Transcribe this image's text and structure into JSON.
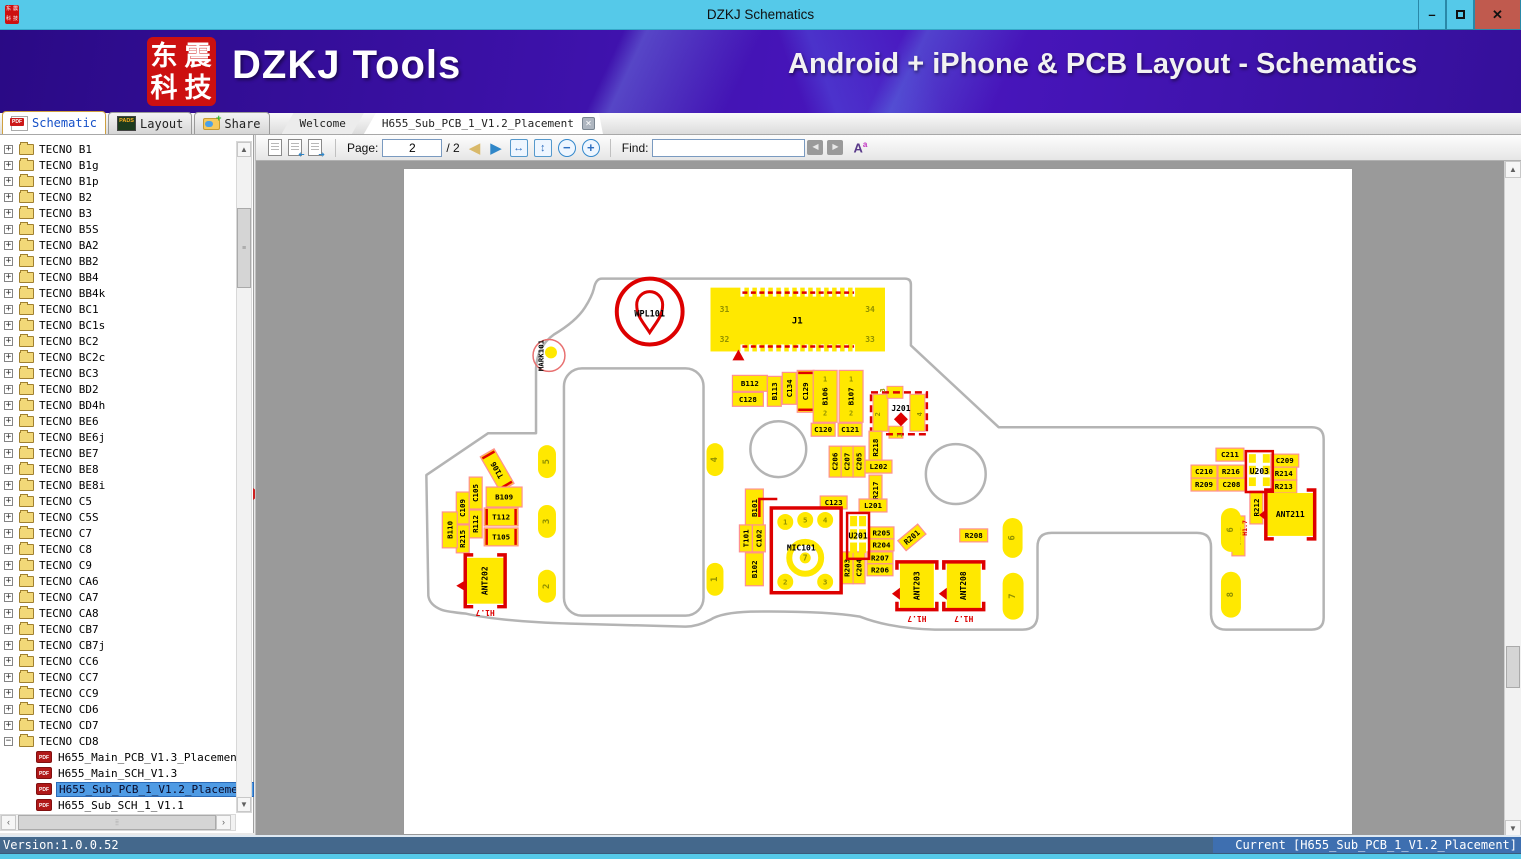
{
  "window": {
    "title": "DZKJ Schematics"
  },
  "banner": {
    "logo_chars": "东震科技",
    "app_name": "DZKJ Tools",
    "tagline": "Android + iPhone & PCB Layout - Schematics"
  },
  "icons": {
    "pdf": "PDF",
    "pads": "PADS"
  },
  "tool_tabs": [
    {
      "label": "Schematic",
      "active": true
    },
    {
      "label": "Layout",
      "active": false
    },
    {
      "label": "Share",
      "active": false
    }
  ],
  "doc_tabs": [
    {
      "label": "Welcome",
      "active": false
    },
    {
      "label": "H655_Sub_PCB_1_V1.2_Placement",
      "active": true
    }
  ],
  "toolbar": {
    "page_label": "Page:",
    "page_value": "2",
    "page_total_display": "/ 2",
    "find_label": "Find:",
    "find_value": ""
  },
  "sidebar": {
    "folders": [
      "TECNO B1",
      "TECNO B1g",
      "TECNO B1p",
      "TECNO B2",
      "TECNO B3",
      "TECNO B5S",
      "TECNO BA2",
      "TECNO BB2",
      "TECNO BB4",
      "TECNO BB4k",
      "TECNO BC1",
      "TECNO BC1s",
      "TECNO BC2",
      "TECNO BC2c",
      "TECNO BC3",
      "TECNO BD2",
      "TECNO BD4h",
      "TECNO BE6",
      "TECNO BE6j",
      "TECNO BE7",
      "TECNO BE8",
      "TECNO BE8i",
      "TECNO C5",
      "TECNO C5S",
      "TECNO C7",
      "TECNO C8",
      "TECNO C9",
      "TECNO CA6",
      "TECNO CA7",
      "TECNO CA8",
      "TECNO CB7",
      "TECNO CB7j",
      "TECNO CC6",
      "TECNO CC7",
      "TECNO CC9",
      "TECNO CD6",
      "TECNO CD7",
      "TECNO CD8"
    ],
    "expanded_folder": "TECNO CD8",
    "files": [
      "H655_Main_PCB_V1.3_Placement",
      "H655_Main_SCH_V1.3",
      "H655_Sub_PCB_1_V1.2_Placement",
      "H655_Sub_SCH_1_V1.1"
    ],
    "selected_index": 2
  },
  "statusbar": {
    "left": "Version:1.0.0.52",
    "right": "Current [H655_Sub_PCB_1_V1.2_Placement]"
  },
  "pcb": {
    "colors": {
      "yellow": "#ffe800",
      "red": "#dd0000",
      "pink": "#ff9090",
      "outline": "#b4b4b4",
      "olive": "#8f8f00"
    },
    "outline_path": "M 198,110 L 502,110 Q 508,110 508,116 L 508,177 L 596,259 L 910,259 Q 922,259 922,271 L 922,450 Q 922,462 910,462 L 824,462 Q 810,462 809,447 L 809,379 Q 809,365 795,365 L 649,365 Q 635,365 635,379 L 635,447 Q 635,462 620,462 L 532,462 Q 488,461 457,449 Q 420,443 347,444 Q 318,445 307,452 Q 294,459 282,459 L 167,456 Q 98,454 62,446 Q 42,444 37,442 Q 25,437 24,428 L 22,307 L 84,265 L 132,265 L 132,200 Q 133,178 150,166 Q 172,153 181,139 Q 188,128 190,120 Q 192,110 198,110 Z",
    "hole": {
      "x": 160,
      "y": 200,
      "w": 140,
      "h": 248,
      "r": 18
    },
    "circles": [
      {
        "cx": 375,
        "cy": 281,
        "r": 28
      },
      {
        "cx": 553,
        "cy": 306,
        "r": 30
      }
    ],
    "mark": {
      "label": "MARK101",
      "cx": 145,
      "cy": 187,
      "r": 16
    },
    "wpl": {
      "label": "WPL101",
      "cx": 246,
      "cy": 143,
      "r": 33
    },
    "j1": {
      "label": "J1",
      "x": 307,
      "w": 175,
      "nums": {
        "tl": "31",
        "tr": "34",
        "bl": "32",
        "br": "33"
      }
    },
    "j201": {
      "label": "J201",
      "x": 468,
      "y": 224,
      "w": 56,
      "h": 42,
      "pads": [
        [
          470,
          226,
          15,
          37
        ],
        [
          507,
          226,
          15,
          37
        ],
        [
          484,
          218,
          16,
          12
        ],
        [
          486,
          258,
          14,
          12
        ]
      ],
      "nums": [
        {
          "n": "3",
          "x": 480,
          "y": 222
        },
        {
          "n": "2",
          "x": 475,
          "y": 246
        },
        {
          "n": "4",
          "x": 517,
          "y": 246
        },
        {
          "n": "1",
          "x": 497,
          "y": 267
        }
      ]
    },
    "mic": {
      "label": "MIC101",
      "x": 368,
      "y": 340,
      "w": 70,
      "h": 85,
      "small": [
        {
          "n": "1",
          "cx": 382,
          "cy": 354
        },
        {
          "n": "5",
          "cx": 402,
          "cy": 352
        },
        {
          "n": "4",
          "cx": 422,
          "cy": 352
        },
        {
          "n": "2",
          "cx": 382,
          "cy": 414
        },
        {
          "n": "3",
          "cx": 422,
          "cy": 414
        }
      ],
      "big": {
        "n": "7",
        "cx": 402,
        "cy": 390
      }
    },
    "smd": [
      {
        "l": "B112",
        "x": 329,
        "y": 207,
        "w": 35,
        "h": 16
      },
      {
        "l": "C128",
        "x": 329,
        "y": 224,
        "w": 31,
        "h": 14
      },
      {
        "l": "B113",
        "x": 364,
        "y": 208,
        "w": 14,
        "h": 30,
        "r": -90
      },
      {
        "l": "C134",
        "x": 379,
        "y": 204,
        "w": 14,
        "h": 32,
        "r": -90
      },
      {
        "l": "C129",
        "x": 394,
        "y": 202,
        "w": 17,
        "h": 42,
        "r": -90,
        "st": "v"
      },
      {
        "l": "B106",
        "x": 410,
        "y": 202,
        "w": 24,
        "h": 52,
        "r": -90,
        "pins": true
      },
      {
        "l": "B107",
        "x": 436,
        "y": 202,
        "w": 24,
        "h": 52,
        "r": -90,
        "pins": true
      },
      {
        "l": "C120",
        "x": 408,
        "y": 255,
        "w": 24,
        "h": 13
      },
      {
        "l": "C121",
        "x": 435,
        "y": 255,
        "w": 24,
        "h": 13
      },
      {
        "l": "T106",
        "x": 85,
        "y": 282,
        "w": 16,
        "h": 40,
        "r": -90,
        "st": "v",
        "pr": -30
      },
      {
        "l": "C109",
        "x": 52,
        "y": 324,
        "w": 13,
        "h": 32,
        "r": -90
      },
      {
        "l": "C105",
        "x": 65,
        "y": 309,
        "w": 13,
        "h": 32,
        "r": -90
      },
      {
        "l": "B109",
        "x": 82,
        "y": 319,
        "w": 36,
        "h": 20
      },
      {
        "l": "R112",
        "x": 65,
        "y": 342,
        "w": 13,
        "h": 28,
        "r": -90
      },
      {
        "l": "R215",
        "x": 52,
        "y": 357,
        "w": 13,
        "h": 28,
        "r": -90
      },
      {
        "l": "B110",
        "x": 38,
        "y": 344,
        "w": 15,
        "h": 36,
        "r": -90
      },
      {
        "l": "T112",
        "x": 80,
        "y": 340,
        "w": 34,
        "h": 18,
        "st": "h"
      },
      {
        "l": "T105",
        "x": 80,
        "y": 360,
        "w": 34,
        "h": 18,
        "st": "h"
      },
      {
        "l": "B101",
        "x": 342,
        "y": 321,
        "w": 18,
        "h": 38,
        "r": -90
      },
      {
        "l": "T101",
        "x": 336,
        "y": 357,
        "w": 13,
        "h": 27,
        "r": -90
      },
      {
        "l": "C102",
        "x": 349,
        "y": 357,
        "w": 13,
        "h": 27,
        "r": -90
      },
      {
        "l": "B102",
        "x": 342,
        "y": 385,
        "w": 18,
        "h": 33,
        "r": -90
      },
      {
        "l": "C123",
        "x": 417,
        "y": 328,
        "w": 27,
        "h": 13
      },
      {
        "l": "R205",
        "x": 466,
        "y": 359,
        "w": 25,
        "h": 12
      },
      {
        "l": "R204",
        "x": 466,
        "y": 371,
        "w": 25,
        "h": 12
      },
      {
        "l": "R203",
        "x": 438,
        "y": 384,
        "w": 12,
        "h": 32,
        "r": -90
      },
      {
        "l": "C204",
        "x": 450,
        "y": 384,
        "w": 12,
        "h": 32,
        "r": -90
      },
      {
        "l": "R207",
        "x": 464,
        "y": 384,
        "w": 26,
        "h": 12
      },
      {
        "l": "R206",
        "x": 464,
        "y": 396,
        "w": 26,
        "h": 12
      },
      {
        "l": "R201",
        "x": 496,
        "y": 363,
        "w": 26,
        "h": 13,
        "pr": -40
      },
      {
        "l": "R208",
        "x": 557,
        "y": 361,
        "w": 28,
        "h": 13
      },
      {
        "l": "C206",
        "x": 426,
        "y": 278,
        "w": 12,
        "h": 31,
        "r": -90
      },
      {
        "l": "C207",
        "x": 438,
        "y": 278,
        "w": 12,
        "h": 31,
        "r": -90
      },
      {
        "l": "C205",
        "x": 450,
        "y": 278,
        "w": 12,
        "h": 31,
        "r": -90
      },
      {
        "l": "R218",
        "x": 466,
        "y": 263,
        "w": 13,
        "h": 33,
        "r": -90
      },
      {
        "l": "L202",
        "x": 462,
        "y": 292,
        "w": 27,
        "h": 13
      },
      {
        "l": "R217",
        "x": 466,
        "y": 307,
        "w": 13,
        "h": 31,
        "r": -90
      },
      {
        "l": "L201",
        "x": 456,
        "y": 331,
        "w": 28,
        "h": 13
      },
      {
        "l": "C211",
        "x": 814,
        "y": 280,
        "w": 28,
        "h": 13
      },
      {
        "l": "C210",
        "x": 789,
        "y": 297,
        "w": 26,
        "h": 13
      },
      {
        "l": "R216",
        "x": 816,
        "y": 297,
        "w": 26,
        "h": 13
      },
      {
        "l": "C209",
        "x": 869,
        "y": 286,
        "w": 28,
        "h": 13
      },
      {
        "l": "R214",
        "x": 869,
        "y": 299,
        "w": 26,
        "h": 13
      },
      {
        "l": "R209",
        "x": 789,
        "y": 310,
        "w": 26,
        "h": 13
      },
      {
        "l": "C208",
        "x": 816,
        "y": 310,
        "w": 27,
        "h": 13
      },
      {
        "l": "R213",
        "x": 869,
        "y": 312,
        "w": 26,
        "h": 13
      },
      {
        "l": "R212",
        "x": 848,
        "y": 323,
        "w": 13,
        "h": 33,
        "r": -90
      },
      {
        "l": "R211",
        "x": 830,
        "y": 348,
        "w": 13,
        "h": 40,
        "r": -90
      }
    ],
    "ubox": [
      {
        "l": "U201",
        "x": 444,
        "y": 345,
        "w": 22,
        "h": 46
      },
      {
        "l": "U203",
        "x": 844,
        "y": 283,
        "w": 27,
        "h": 41
      }
    ],
    "ants": [
      {
        "l": "ANT202",
        "x": 62,
        "y": 390,
        "w": 38,
        "h": 46,
        "o": "v",
        "lr": -90
      },
      {
        "l": "ANT203",
        "x": 497,
        "y": 395,
        "w": 34,
        "h": 46,
        "o": "h",
        "lr": -90
      },
      {
        "l": "ANT208",
        "x": 544,
        "y": 395,
        "w": 34,
        "h": 46,
        "o": "h",
        "lr": -90
      },
      {
        "l": "ANT211",
        "x": 865,
        "y": 325,
        "w": 47,
        "h": 43,
        "o": "v",
        "lr": 0
      }
    ],
    "pads": [
      {
        "n": "5",
        "x": 134,
        "y": 277,
        "w": 18,
        "h": 33
      },
      {
        "n": "3",
        "x": 134,
        "y": 337,
        "w": 18,
        "h": 33
      },
      {
        "n": "2",
        "x": 134,
        "y": 402,
        "w": 18,
        "h": 33
      },
      {
        "n": "4",
        "x": 303,
        "y": 275,
        "w": 17,
        "h": 33
      },
      {
        "n": "1",
        "x": 303,
        "y": 395,
        "w": 17,
        "h": 33
      },
      {
        "n": "6",
        "x": 600,
        "y": 350,
        "w": 20,
        "h": 40
      },
      {
        "n": "7",
        "x": 600,
        "y": 405,
        "w": 21,
        "h": 47
      },
      {
        "n": "6",
        "x": 819,
        "y": 340,
        "w": 20,
        "h": 44
      },
      {
        "n": "8",
        "x": 819,
        "y": 404,
        "w": 20,
        "h": 46
      }
    ],
    "red_texts": [
      {
        "t": "H1.7",
        "x": 81,
        "y": 445,
        "r": 180,
        "s": 8
      },
      {
        "t": "H1.7",
        "x": 514,
        "y": 451,
        "r": 180,
        "s": 8
      },
      {
        "t": "H1.7",
        "x": 561,
        "y": 451,
        "r": 180,
        "s": 8
      },
      {
        "t": "H1.7",
        "x": 843,
        "y": 360,
        "r": -90,
        "s": 6.5
      }
    ],
    "triangles": [
      {
        "p": "335,181 329,192 341,192"
      },
      {
        "p": "62,412 62,424 52,418"
      },
      {
        "p": "497,420 497,432 489,426"
      },
      {
        "p": "544,420 544,432 536,426"
      },
      {
        "p": "865,341 865,353 857,347"
      }
    ]
  }
}
